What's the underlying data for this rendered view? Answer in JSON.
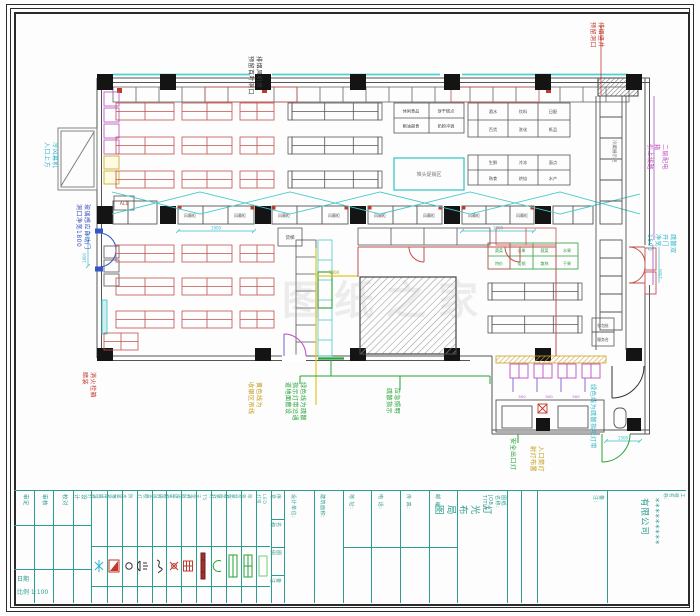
{
  "watermark": "图纸之家",
  "ann": {
    "top_black": "排烟风机房\n预留百叶洞口",
    "red_top_right": "排烟竖井\n预留洞口",
    "cyan_left": "冷风幕机\n入口上方",
    "blue_door": "玻璃感应自动门\n洞口净宽1800",
    "red_bl": "消火栓箱\n暗装",
    "olive_mid": "黄色线为\n收银区吊线",
    "green_mid": "绿色线为疏散\n指示灯带沿通\n道地面敷设",
    "green_mid2": "应急照明\n疏散指示",
    "green_right": "安全出口灯",
    "olive_right": "入口筒灯\n射灯布置",
    "cyan_rb": "绿色线为疏散指示灯带",
    "magenta_r": "二层配电箱\n引上线路",
    "cyan_rm": "疏散双开门\n净宽1500"
  },
  "labels": {
    "freezer": "风幕柜",
    "corridor": "冷藏展示柜",
    "promo": "堆头促销区",
    "lift": "货梯",
    "al": "AL1",
    "service1": "存包处",
    "service2": "服务台",
    "t1": [
      "休闲食品",
      "饼干糕点",
      "粮油副食",
      "奶粉冲调"
    ],
    "t2": [
      "酒水",
      "饮料",
      "日配",
      "百货",
      "洗化",
      "纸品"
    ],
    "t2b": [
      "生鲜",
      "冷冻",
      "面点",
      "熟食",
      "烘焙",
      "水产"
    ],
    "produce": [
      "蔬菜",
      "水果",
      "蔬菜",
      "水果",
      "特价",
      "促销",
      "散称",
      "干果"
    ]
  },
  "dims": {
    "d1": "1900",
    "d2": "1800",
    "d3": "1500",
    "d4": "500",
    "d5": "5000"
  },
  "titleblock": {
    "rev_cols": [
      "审定",
      "审核",
      "校对",
      "设计"
    ],
    "rev_date": "日期",
    "rev_scale": "比例 1:100",
    "legend_rows": [
      "序号",
      "名称",
      "图例",
      "备注"
    ],
    "legend_names": [
      "吸顶灯",
      "安全出口灯",
      "防水吸顶灯",
      "壁灯",
      "接线盒",
      "应急壁灯",
      "疏散指示灯",
      "T5支架灯",
      "筒灯",
      "双管荧光灯",
      "单管荧光灯",
      "LED灯带"
    ],
    "info_cols": [
      "设计单位:",
      "建筑面积:",
      "地 址:",
      "电 话:",
      "传 真:",
      "邮 编:"
    ],
    "job_title_label": "图纸名称:\nJOB TITLE",
    "drawing_title": "灯光布局图",
    "remarks": "备注:",
    "project_label": "工程名称:",
    "company": "*********有限公司"
  }
}
